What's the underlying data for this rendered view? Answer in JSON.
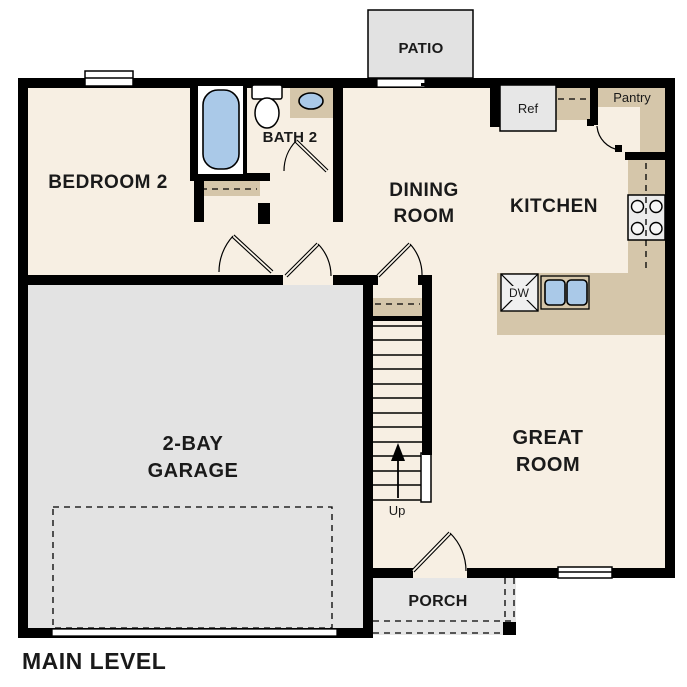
{
  "plan": {
    "title": "MAIN LEVEL",
    "rooms": {
      "patio": "PATIO",
      "bedroom2": "BEDROOM 2",
      "bath2": "BATH 2",
      "dining_line1": "DINING",
      "dining_line2": "ROOM",
      "kitchen": "KITCHEN",
      "garage_line1": "2-BAY",
      "garage_line2": "GARAGE",
      "great_line1": "GREAT",
      "great_line2": "ROOM",
      "porch": "PORCH"
    },
    "fixtures": {
      "refrigerator": "Ref",
      "pantry": "Pantry",
      "dishwasher": "DW",
      "stairs_up": "Up"
    },
    "colors": {
      "floor_cream": "#f7efe3",
      "counter_tan": "#d5c6aa",
      "fixture_blue": "#aac9e8",
      "garage_gray": "#e3e3e3",
      "patio_gray": "#e2e2e2",
      "porch_gray": "#e6e6e6",
      "wall_black": "#000000"
    }
  }
}
